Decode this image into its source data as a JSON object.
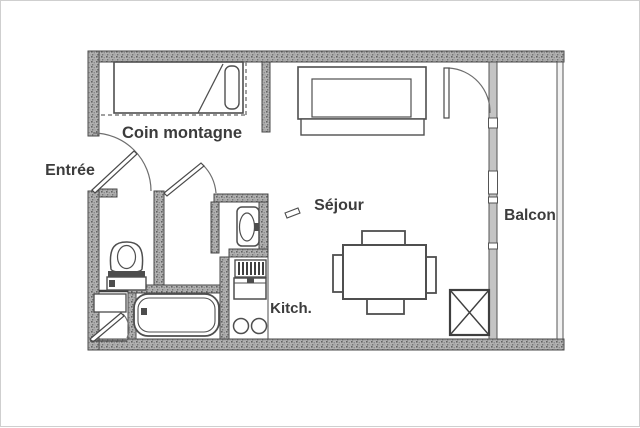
{
  "title": "Studio apartment floor plan",
  "labels": {
    "entree": "Entrée",
    "coin_montagne": "Coin montagne",
    "sejour": "Séjour",
    "balcon": "Balcon",
    "kitchen": "Kitch."
  },
  "rooms": [
    {
      "name": "entree",
      "label": "Entrée"
    },
    {
      "name": "coin-montagne",
      "label": "Coin montagne"
    },
    {
      "name": "sejour",
      "label": "Séjour"
    },
    {
      "name": "balcon",
      "label": "Balcon"
    },
    {
      "name": "kitchenette",
      "label": "Kitch."
    },
    {
      "name": "bathroom",
      "label": ""
    }
  ],
  "fixtures": [
    "single-bed",
    "pillow",
    "sofa",
    "dining-table",
    "chair",
    "toilet",
    "washbasin",
    "bathtub",
    "stove-burners",
    "kitchen-unit",
    "crossed-storage-box",
    "entry-door",
    "interior-door",
    "balcony-door",
    "closet-door",
    "window-wall"
  ],
  "colors": {
    "background": "#ffffff",
    "wall_fill": "#b3b3b3",
    "wall_speckle": "#6b6b6b",
    "line": "#4a4a4a",
    "label_text": "#3c3c3c",
    "frame_border": "#cfcfcf"
  }
}
